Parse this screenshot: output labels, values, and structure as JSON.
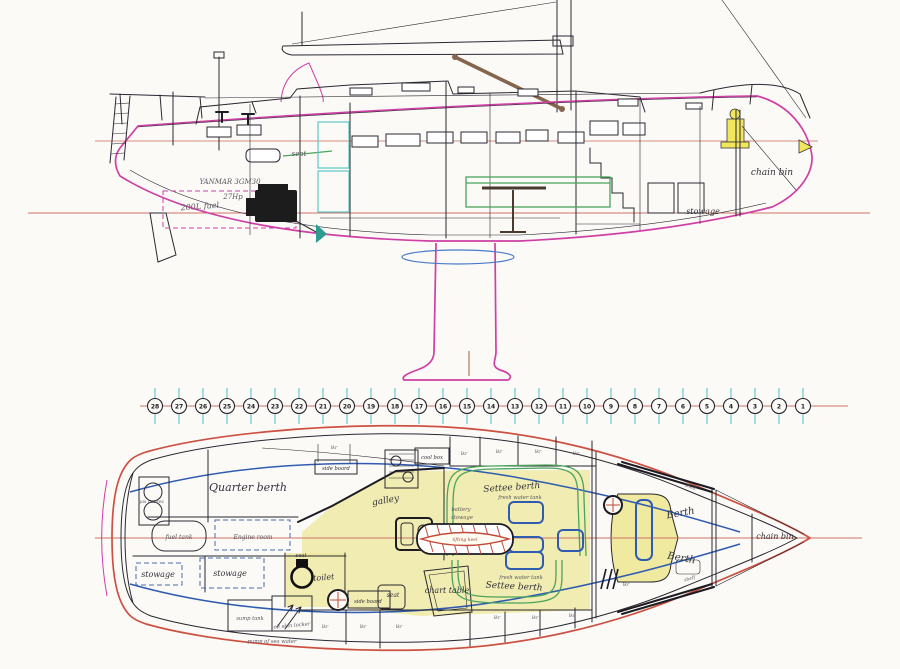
{
  "document": {
    "title": "sailing yacht general arrangement drawing",
    "views": [
      "profile (side) view",
      "station scale",
      "interior plan view"
    ]
  },
  "colors": {
    "hull_magenta": "#cf3fa5",
    "reference_salmon": "#cc7365",
    "plan_hull_red": "#cc5142",
    "waterline_blue": "#2f5cb0",
    "station_tick_cyan": "#8bd7d7",
    "settee_green": "#4aa45c",
    "sole_yellow": "#efe9a0",
    "highlight_yellow": "#f2e65c",
    "keel_hatch_red": "#c04a3a"
  },
  "profile": {
    "labels": {
      "seat": "seat",
      "engine_model": "YANMAR 3GM30",
      "engine_power": "27Hp",
      "fuel_capacity": "200L fuel",
      "chain_bin": "chain bin",
      "stowage": "stowage"
    }
  },
  "stations": {
    "numbers": [
      "28",
      "27",
      "26",
      "25",
      "24",
      "23",
      "22",
      "21",
      "20",
      "19",
      "18",
      "17",
      "16",
      "15",
      "14",
      "13",
      "12",
      "11",
      "10",
      "9",
      "8",
      "7",
      "6",
      "5",
      "4",
      "3",
      "2",
      "1"
    ]
  },
  "plan": {
    "labels": {
      "gas_bottles": "gas bottles",
      "quarter_berth": "Quarter berth",
      "fuel_tank": "fuel tank",
      "engine_room": "Engine room",
      "stowage": "stowage",
      "side_board": "side board",
      "locker_abbrev": "lkr",
      "galley": "galley",
      "cool_box": "cool box",
      "settee_berth": "Settee berth",
      "fresh_water_tank": "fresh water tank",
      "battery_line1": "battery",
      "battery_line2": "stowage",
      "lifting_keel": "lifting keel",
      "seat": "seat",
      "toilet": "toilet",
      "sump_tank": "sump tank",
      "oil_skin_locker": "oil skin locker",
      "chart_table": "chart table",
      "pump_sea_water": "pump of sea water",
      "berth": "Berth",
      "chain_bin": "chain bin",
      "shelf": "shelf"
    }
  }
}
